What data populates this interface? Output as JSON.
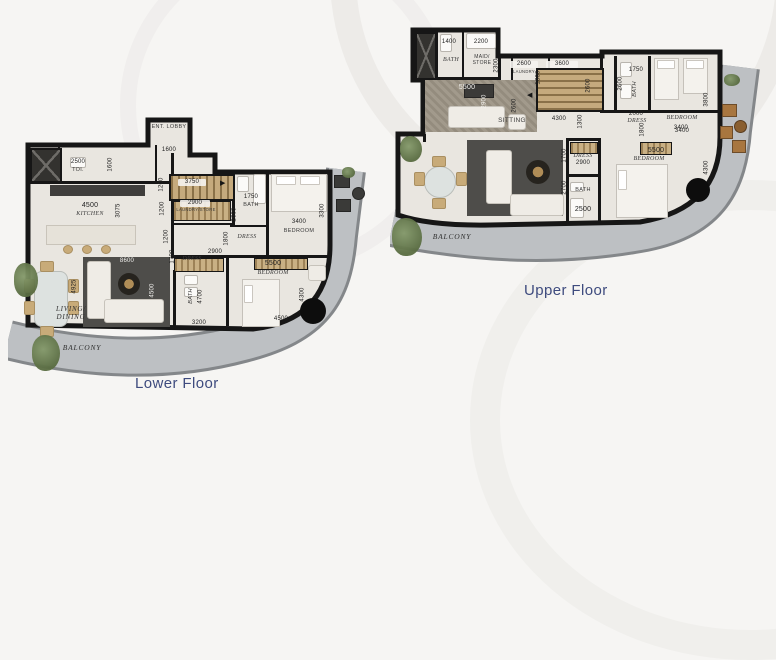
{
  "captions": {
    "lower": "Lower Floor",
    "upper": "Upper Floor"
  },
  "colors": {
    "caption": "#3e4b7e",
    "wall": "#161616",
    "balcony": "#bdc0c3",
    "floor": "#e9e6e0"
  },
  "icons": {
    "stairs_arrow_right": "▶",
    "stairs_arrow_left": "◀"
  },
  "lower": {
    "rooms": {
      "ent_lobby": {
        "name": "ENT. LOBBY",
        "dim_w": "1600"
      },
      "toi": {
        "dim_w": "2500",
        "name": "TOI.",
        "dim_h": "1600"
      },
      "kitchen": {
        "dim_w": "4500",
        "name": "KITCHEN",
        "dim_h": "3075"
      },
      "stairs": {
        "dim_w": "3750",
        "dim_h": "1200"
      },
      "laundry": {
        "dim_w": "2900",
        "name": "LAUNDRY/STORE",
        "dim_h": "1200"
      },
      "hall": {
        "dim_h": "1200"
      },
      "bath1": {
        "dim_w": "1750",
        "name": "BATH",
        "dim_h": "2600"
      },
      "dress1": {
        "name": "DRESS",
        "dim_h": "1800"
      },
      "bedroom1": {
        "dim_w": "3400",
        "name": "BEDROOM",
        "dim_h": "3300"
      },
      "dress2": {
        "name": "DRESS",
        "dim_w": "2900",
        "dim_h": "1700"
      },
      "bedroom2": {
        "dim_w": "5500",
        "name": "BEDROOM",
        "dim_h": "4300",
        "dim_w2": "4500"
      },
      "bath2": {
        "name": "BATH",
        "dim_h": "4700",
        "dim_w": "3200"
      },
      "living": {
        "dim_w": "8600",
        "dim_h": "4925",
        "dim_h2": "4500",
        "name": "LIVING/ DINING"
      },
      "balcony": {
        "name": "BALCONY"
      }
    }
  },
  "upper": {
    "rooms": {
      "bath1": {
        "dim_w": "1400",
        "name": "BATH"
      },
      "maid": {
        "dim_w": "2200",
        "name": "MAID/ STORE",
        "dim_h": "2300"
      },
      "laundry": {
        "dim_w": "2600",
        "name": "LAUNDRY",
        "dim_h": "1800"
      },
      "stairs": {
        "dim_w": "3600",
        "dim_h": "2600"
      },
      "hall": {
        "dim_w": "4300",
        "dim_h": "1300",
        "dim_h2": "2600"
      },
      "bath2": {
        "dim_w": "1750",
        "name": "BATH",
        "dim_h": "2600"
      },
      "dress1": {
        "dim_w": "2000",
        "name": "DRESS",
        "dim_h": "1800"
      },
      "bedroom1": {
        "name": "BEDROOM",
        "dim_w": "3400",
        "dim_h": "3800"
      },
      "sitting": {
        "dim_w": "5500",
        "dim_h": "2900",
        "name": "SITTING"
      },
      "dress2": {
        "name": "DRESS",
        "dim_w": "2900",
        "dim_h": "1700"
      },
      "bath3": {
        "name": "BATH",
        "dim_w": "2500",
        "dim_h": "2700"
      },
      "bedroom2": {
        "dim_w2": "3400",
        "dim_w": "5500",
        "name": "BEDROOM",
        "dim_h": "4300"
      },
      "balcony": {
        "name": "BALCONY"
      }
    }
  }
}
